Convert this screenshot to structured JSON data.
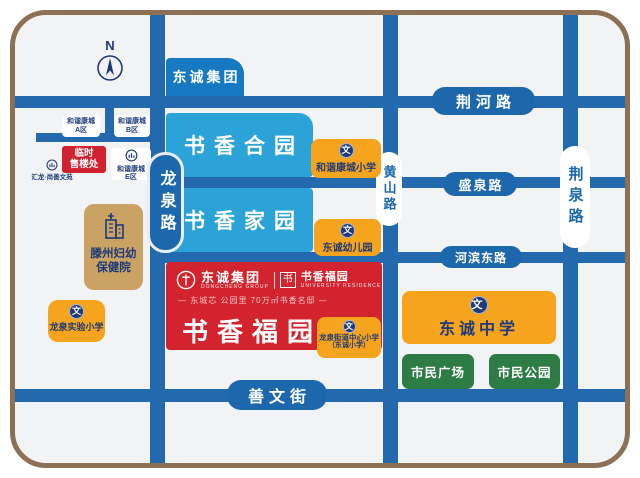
{
  "compass": {
    "label": "N"
  },
  "roads": {
    "jinghe_lu": "荆河路",
    "shengquan_lu": "盛泉路",
    "hebin_donglu": "河滨东路",
    "shanwen_jie": "善文街",
    "longquan_lu": "龙泉路",
    "huangshan_lu": "黄山路",
    "jingquan_lu": "荆泉路"
  },
  "blocks": {
    "dongcheng_group": "东诚集团",
    "shuxiang_heyuan": "书香合园",
    "shuxiang_jiayuan": "书香家园"
  },
  "project": {
    "logo_cn": "东诚集团",
    "logo_en": "DONGCHENG GROUP",
    "seal": "书",
    "brand": "书香福园",
    "brand_en": "UNIVERSITY RESIDENCE",
    "tagline": "— 东城芯 公园里 70万㎡书香名邸 —",
    "title": "书香福园"
  },
  "pois": {
    "harmony_a": {
      "line1": "和谐康城",
      "line2": "A区"
    },
    "harmony_b": {
      "line1": "和谐康城",
      "line2": "B区"
    },
    "harmony_e": {
      "line1": "和谐康城",
      "line2": "E区"
    },
    "huilong": "汇龙·尚善文苑",
    "temp_sales": {
      "line1": "临时",
      "line2": "售楼处"
    },
    "hospital": {
      "line1": "滕州妇幼",
      "line2": "保健院"
    },
    "longquan_primary": "龙泉实验小学",
    "harmony_primary": "和谐康城小学",
    "kindergarten": "东诚幼儿园",
    "center_primary": {
      "line1": "龙泉街道中心小学",
      "line2": "（东诚小学）"
    },
    "middle_school": "东诚中学",
    "civic_plaza": "市民广场",
    "civic_park": "市民公园"
  },
  "icons": {
    "wen": "文"
  },
  "colors": {
    "road_blue": "#2369ad",
    "light_blue_block": "#2ba3d9",
    "group_blue": "#1779c2",
    "project_red": "#d2232e",
    "school_orange": "#f6a41e",
    "civic_green": "#2d7b45",
    "hospital_tan": "#c9a264",
    "navy_text": "#1e3a78",
    "border_brown": "#8d7053"
  }
}
